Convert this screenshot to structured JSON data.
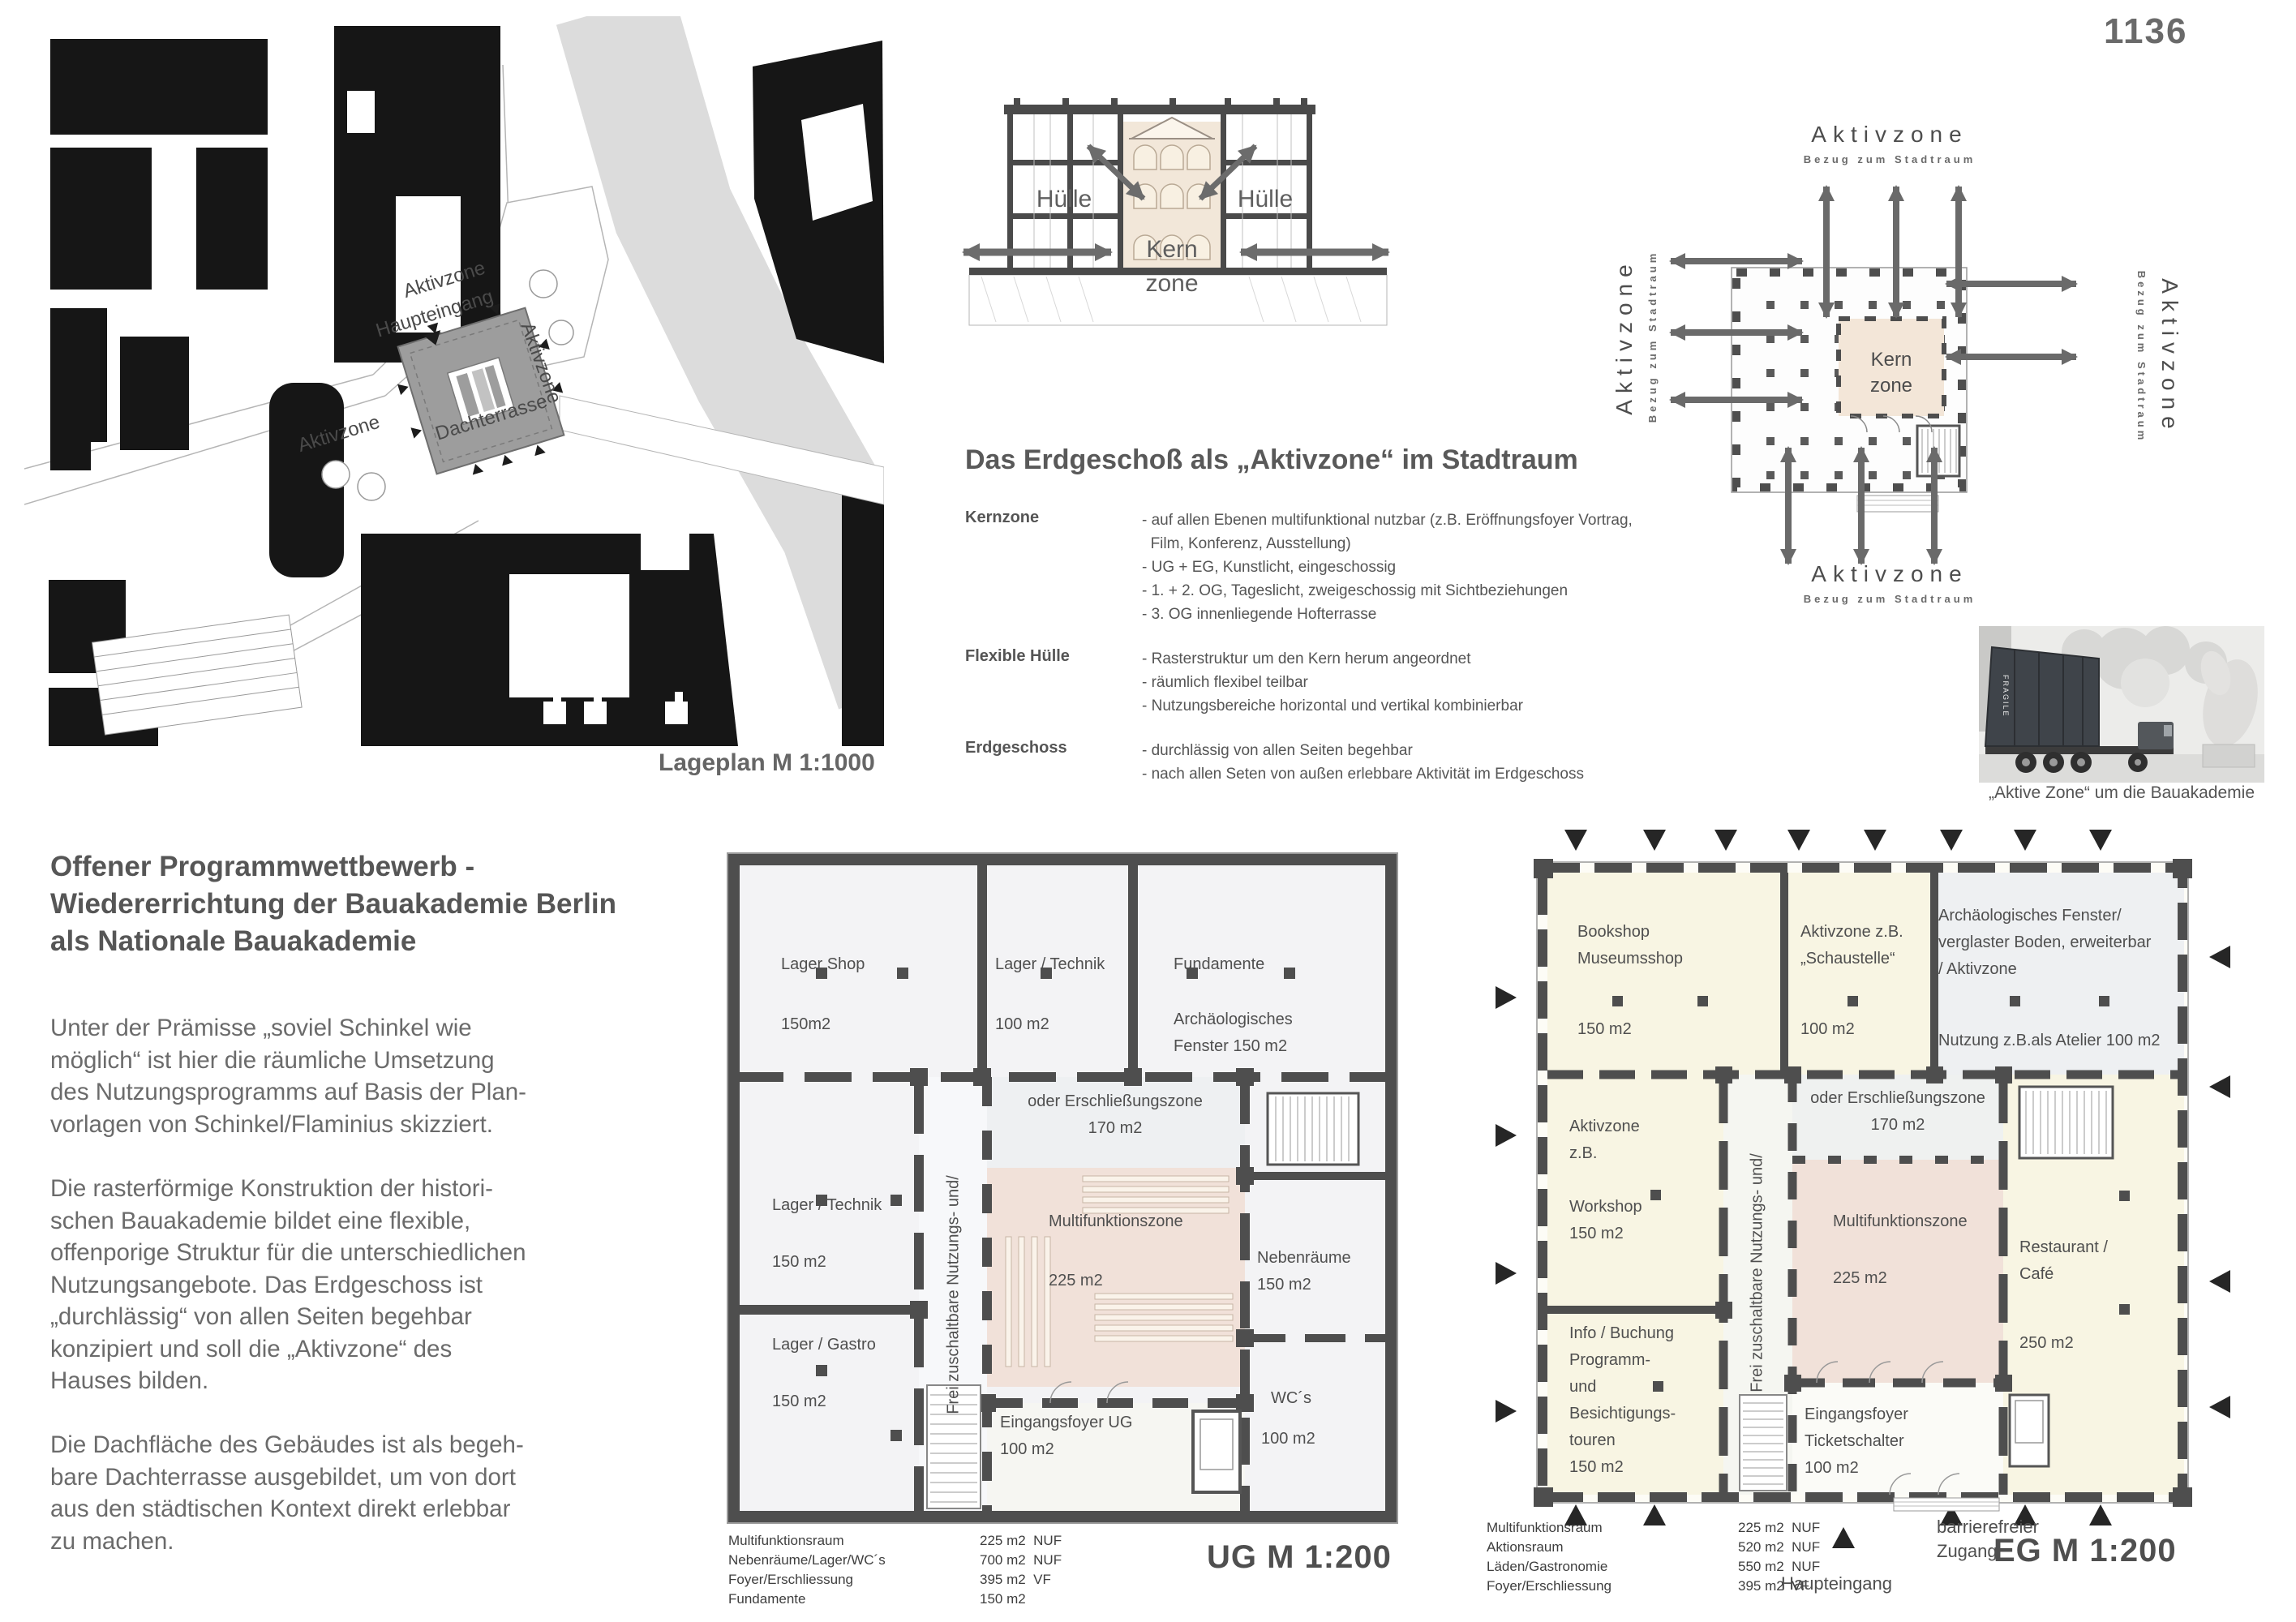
{
  "page": {
    "number": "1136"
  },
  "colors": {
    "wall": "#4e4e4e",
    "kern_pink": "#f1e1d9",
    "cream": "#f8f5e3",
    "river": "#dcdcdc",
    "text_gray": "#6b6b6b"
  },
  "lageplan": {
    "caption": "Lageplan M 1:1000",
    "aktivzone_top": "Aktivzone",
    "aktivzone_right": "Aktivzone",
    "aktivzone_left": "Aktivzone",
    "haupteingang": "Haupteingang",
    "dachterrasse": "Dachterrasse"
  },
  "section": {
    "huelle_left": "Hülle",
    "huelle_right": "Hülle",
    "kern": "Kern",
    "zone": "zone"
  },
  "erdgeschoss_text": {
    "title": "Das Erdgeschoß als „Aktivzone“ im Stadtraum",
    "items": [
      {
        "term": "Kernzone",
        "desc": "- auf allen Ebenen multifunktional nutzbar (z.B. Eröffnungsfoyer Vortrag,\n  Film, Konferenz, Ausstellung)\n- UG + EG, Kunstlicht, eingeschossig\n- 1. + 2. OG, Tageslicht, zweigeschossig mit Sichtbeziehungen\n- 3. OG innenliegende Hofterrasse"
      },
      {
        "term": "Flexible Hülle",
        "desc": "- Rasterstruktur um den Kern herum angeordnet\n- räumlich flexibel teilbar\n- Nutzungsbereiche horizontal und vertikal kombinierbar"
      },
      {
        "term": "Erdgeschoss",
        "desc": "- durchlässig von allen Seiten begehbar\n- nach allen Seten von außen erlebbare Aktivität im Erdgeschoss"
      }
    ]
  },
  "aktiv_diagram": {
    "top_label": "Aktivzone",
    "top_sub": "Bezug zum Stadtraum",
    "bottom_label": "Aktivzone",
    "bottom_sub": "Bezug zum Stadtraum",
    "left_label": "Aktivzone",
    "left_sub": "Bezug zum Stadtraum",
    "right_label": "Aktivzone",
    "right_sub": "Bezug zum Stadtraum",
    "kern": "Kern",
    "zone": "zone"
  },
  "photo": {
    "caption": "„Aktive Zone“ um die Bauakademie",
    "container_label": "FRAGILE"
  },
  "intro": {
    "title": "Offener Programmwettbewerb -\nWiedererrichtung der Bauakademie Berlin\nals Nationale Bauakademie",
    "paragraphs": [
      "Unter der Prämisse „soviel Schinkel wie\nmöglich“ ist hier die räumliche Umsetzung\ndes Nutzungsprogramms auf Basis der Plan-\nvorlagen von Schinkel/Flaminius skizziert.",
      "Die rasterförmige Konstruktion der histori-\nschen Bauakademie bildet eine flexible,\noffenporige Struktur für die unterschiedlichen\nNutzungsangebote. Das Erdgeschoss ist\n„durchlässig“ von allen Seiten begehbar\nkonzipiert und soll die „Aktivzone“ des\nHauses bilden.",
      "Die Dachfläche des Gebäudes ist als begeh-\nbare Dachterrasse ausgebildet, um von dort\naus den städtischen Kontext direkt erlebbar\nzu machen."
    ]
  },
  "ug": {
    "scale_label": "UG M 1:200",
    "rooms": {
      "lager_shop": "Lager Shop",
      "lager_shop_area": "150m2",
      "lager_technik_top": "Lager / Technik",
      "lager_technik_top_area": "100 m2",
      "fundamente": "Fundamente",
      "arch_fenster": "Archäologisches\nFenster 150 m2",
      "lager_technik_left": "Lager / Technik",
      "lager_technik_left_area": "150 m2",
      "lager_gastro": "Lager / Gastro",
      "lager_gastro_area": "150 m2",
      "erschliessung": "oder Erschließungszone\n170 m2",
      "frei_vertical": "Frei zuschaltbare Nutzungs- und/",
      "multifunktion": "Multifunktionszone",
      "multifunktion_area": "225 m2",
      "nebenraeume": "Nebenräume\n150 m2",
      "eingangsfoyer": "Eingangsfoyer UG\n100 m2",
      "wc": "WC´s",
      "wc_area": "100 m2"
    },
    "legend": [
      {
        "name": "Multifunktionsraum",
        "value": "225 m2  NUF"
      },
      {
        "name": "Nebenräume/Lager/WC´s",
        "value": "700 m2  NUF"
      },
      {
        "name": "Foyer/Erschliessung",
        "value": "395 m2  VF"
      },
      {
        "name": "Fundamente",
        "value": "150 m2"
      }
    ]
  },
  "eg": {
    "scale_label": "EG M 1:200",
    "haupteingang": "Haupteingang",
    "barrierefrei": "barrierefreier\nZugang",
    "rooms": {
      "bookshop": "Bookshop\nMuseumsshop",
      "bookshop_area": "150 m2",
      "schaustelle": "Aktivzone z.B.\n„Schaustelle“",
      "schaustelle_area": "100 m2",
      "arch_fenster": "Archäologisches Fenster/\nverglaster Boden, erweiterbar\n/ Aktivzone",
      "atelier": "Nutzung z.B.als Atelier 100 m2",
      "workshop": "Aktivzone\nz.B.\n\nWorkshop\n150 m2",
      "info": "Info / Buchung\nProgramm-\nund\nBesichtigungs-\ntouren\n150 m2",
      "erschliessung": "oder Erschließungszone\n170 m2",
      "frei_vertical": "Frei zuschaltbare Nutzungs- und/",
      "multifunktion": "Multifunktionszone",
      "multifunktion_area": "225 m2",
      "restaurant": "Restaurant /\nCafé",
      "restaurant_area": "250 m2",
      "eingangsfoyer": "Eingangsfoyer\nTicketschalter\n100 m2"
    },
    "legend": [
      {
        "name": "Multifunktionsraum",
        "value": "225 m2  NUF"
      },
      {
        "name": "Aktionsraum",
        "value": "520 m2  NUF"
      },
      {
        "name": "Läden/Gastronomie",
        "value": "550 m2  NUF"
      },
      {
        "name": "Foyer/Erschliessung",
        "value": "395 m2  VF"
      }
    ]
  }
}
